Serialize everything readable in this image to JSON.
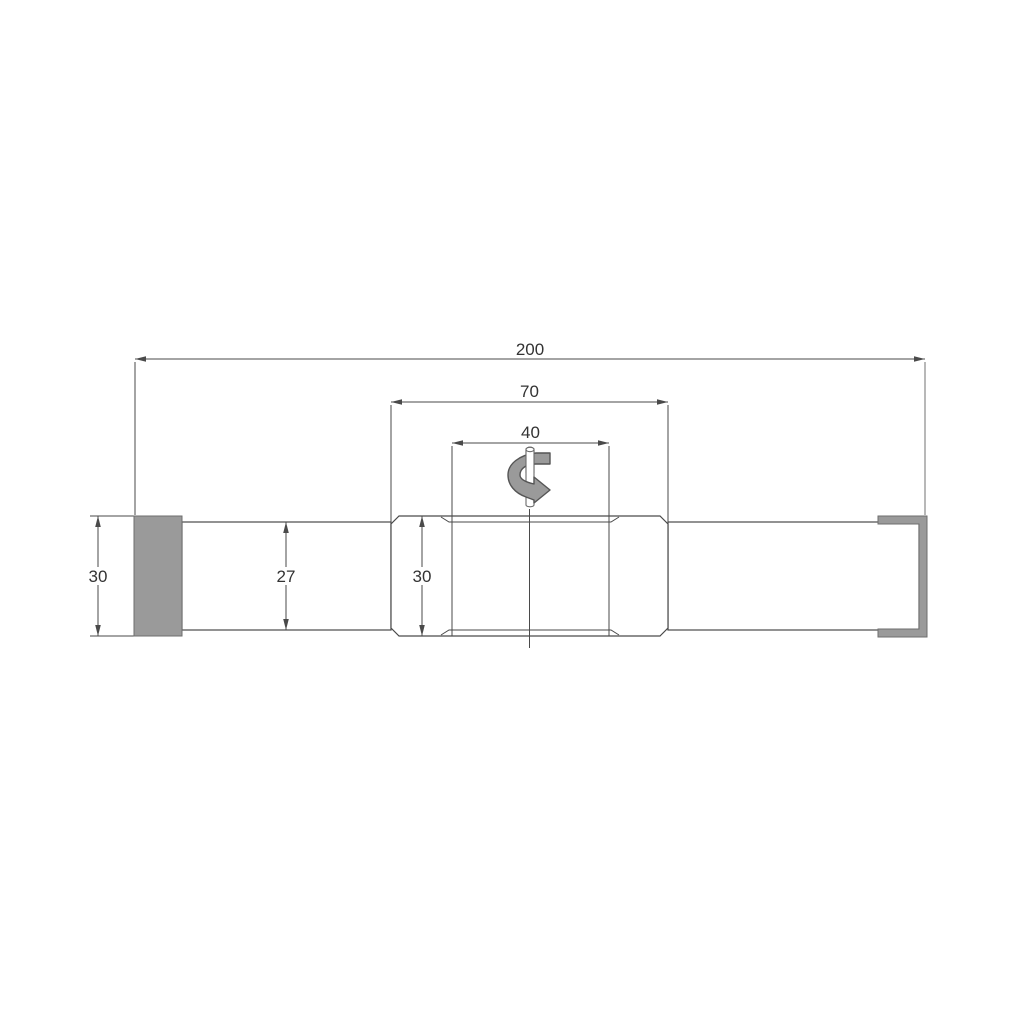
{
  "dimensions": {
    "overall_length": "200",
    "mid_section_length": "70",
    "hex_section_length": "40",
    "left_end_height": "30",
    "shaft_height": "27",
    "mid_section_height": "30"
  },
  "colors": {
    "background": "#ffffff",
    "outline": "#4a4a4a",
    "gray_fill": "#9a9a9a",
    "text": "#333333"
  },
  "icons": {
    "rotation_icon": "curved-arrow-around-vertical-pin"
  }
}
